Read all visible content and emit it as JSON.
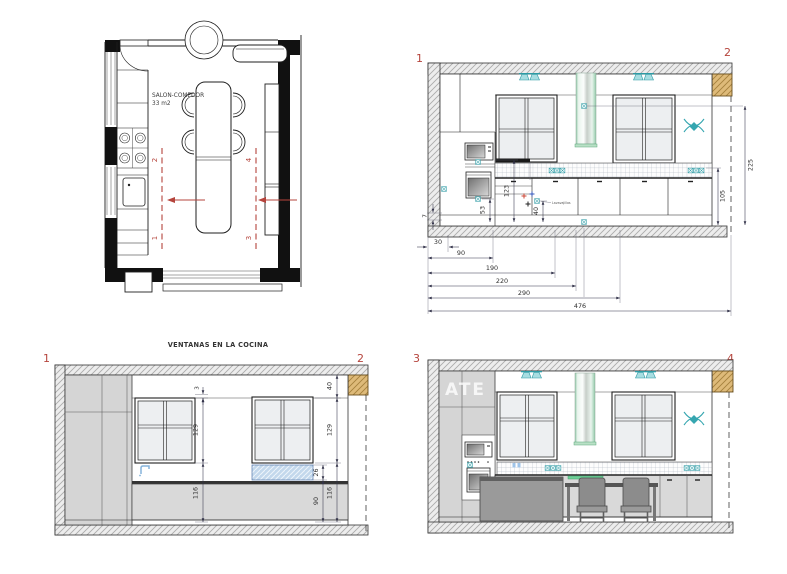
{
  "watermark": "ATE",
  "floor_plan": {
    "room_label": "SALON-COMEDOR",
    "room_area": "33 m2",
    "section_top_left": "2",
    "section_bottom_left": "1",
    "section_top_right": "4",
    "section_bottom_right": "3"
  },
  "elev12": {
    "marker_left": "1",
    "marker_right": "2",
    "note": "Lavavajillas",
    "dims": {
      "v225": "225",
      "v105": "105",
      "v123": "123",
      "v53": "53",
      "v40": "40",
      "v7": "7",
      "h30": "30",
      "h90": "90",
      "h190": "190",
      "h220": "220",
      "h290": "290",
      "h476": "476"
    }
  },
  "elev_windows": {
    "title": "VENTANAS EN LA COCINA",
    "marker_left": "1",
    "marker_right": "2",
    "dims": {
      "top_gap": "3",
      "left_window_h": "129",
      "left_sill_h": "116",
      "right_top": "40",
      "right_window_h": "129",
      "radiator_h": "26",
      "worktop_h": "90",
      "right_sill_h": "116"
    }
  },
  "elev34": {
    "marker_left": "3",
    "marker_right": "4"
  }
}
